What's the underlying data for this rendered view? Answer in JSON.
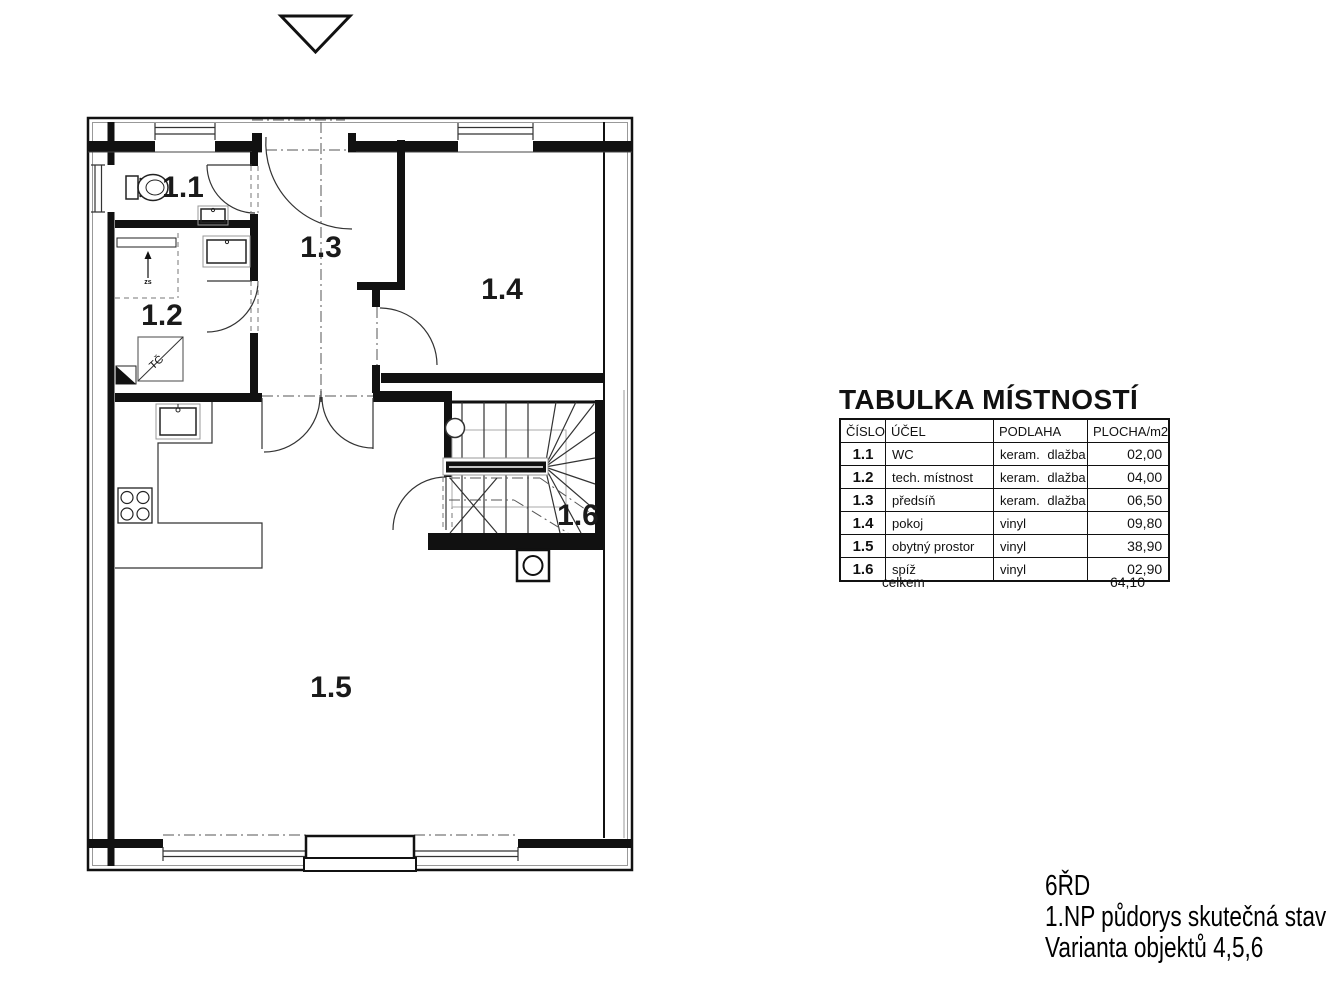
{
  "plan": {
    "rooms": [
      {
        "label": "1.1"
      },
      {
        "label": "1.2"
      },
      {
        "label": "1.3"
      },
      {
        "label": "1.4"
      },
      {
        "label": "1.5"
      },
      {
        "label": "1.6"
      }
    ],
    "annotations": {
      "heat_pump": "TČ",
      "appliance": "zs"
    }
  },
  "table": {
    "title": "TABULKA MÍSTNOSTÍ",
    "headers": [
      "ČÍSLO",
      "ÚČEL",
      "PODLAHA",
      "PLOCHA/m2"
    ],
    "rows": [
      {
        "number": "1.1",
        "purpose": "WC",
        "floor": "keram. dlažba",
        "area": "02,00"
      },
      {
        "number": "1.2",
        "purpose": "tech. místnost",
        "floor": "keram. dlažba",
        "area": "04,00"
      },
      {
        "number": "1.3",
        "purpose": "předsíň",
        "floor": "keram. dlažba",
        "area": "06,50"
      },
      {
        "number": "1.4",
        "purpose": "pokoj",
        "floor": "vinyl",
        "area": "09,80"
      },
      {
        "number": "1.5",
        "purpose": "obytný prostor",
        "floor": "vinyl",
        "area": "38,90"
      },
      {
        "number": "1.6",
        "purpose": "spíž",
        "floor": "vinyl",
        "area": "02,90"
      }
    ],
    "total_label": "celkem",
    "total_value": "64,10"
  },
  "title_block": {
    "line1": "6ŘD",
    "line2": "1.NP půdorys skutečná stav",
    "line3": "Varianta objektů 4,5,6"
  }
}
